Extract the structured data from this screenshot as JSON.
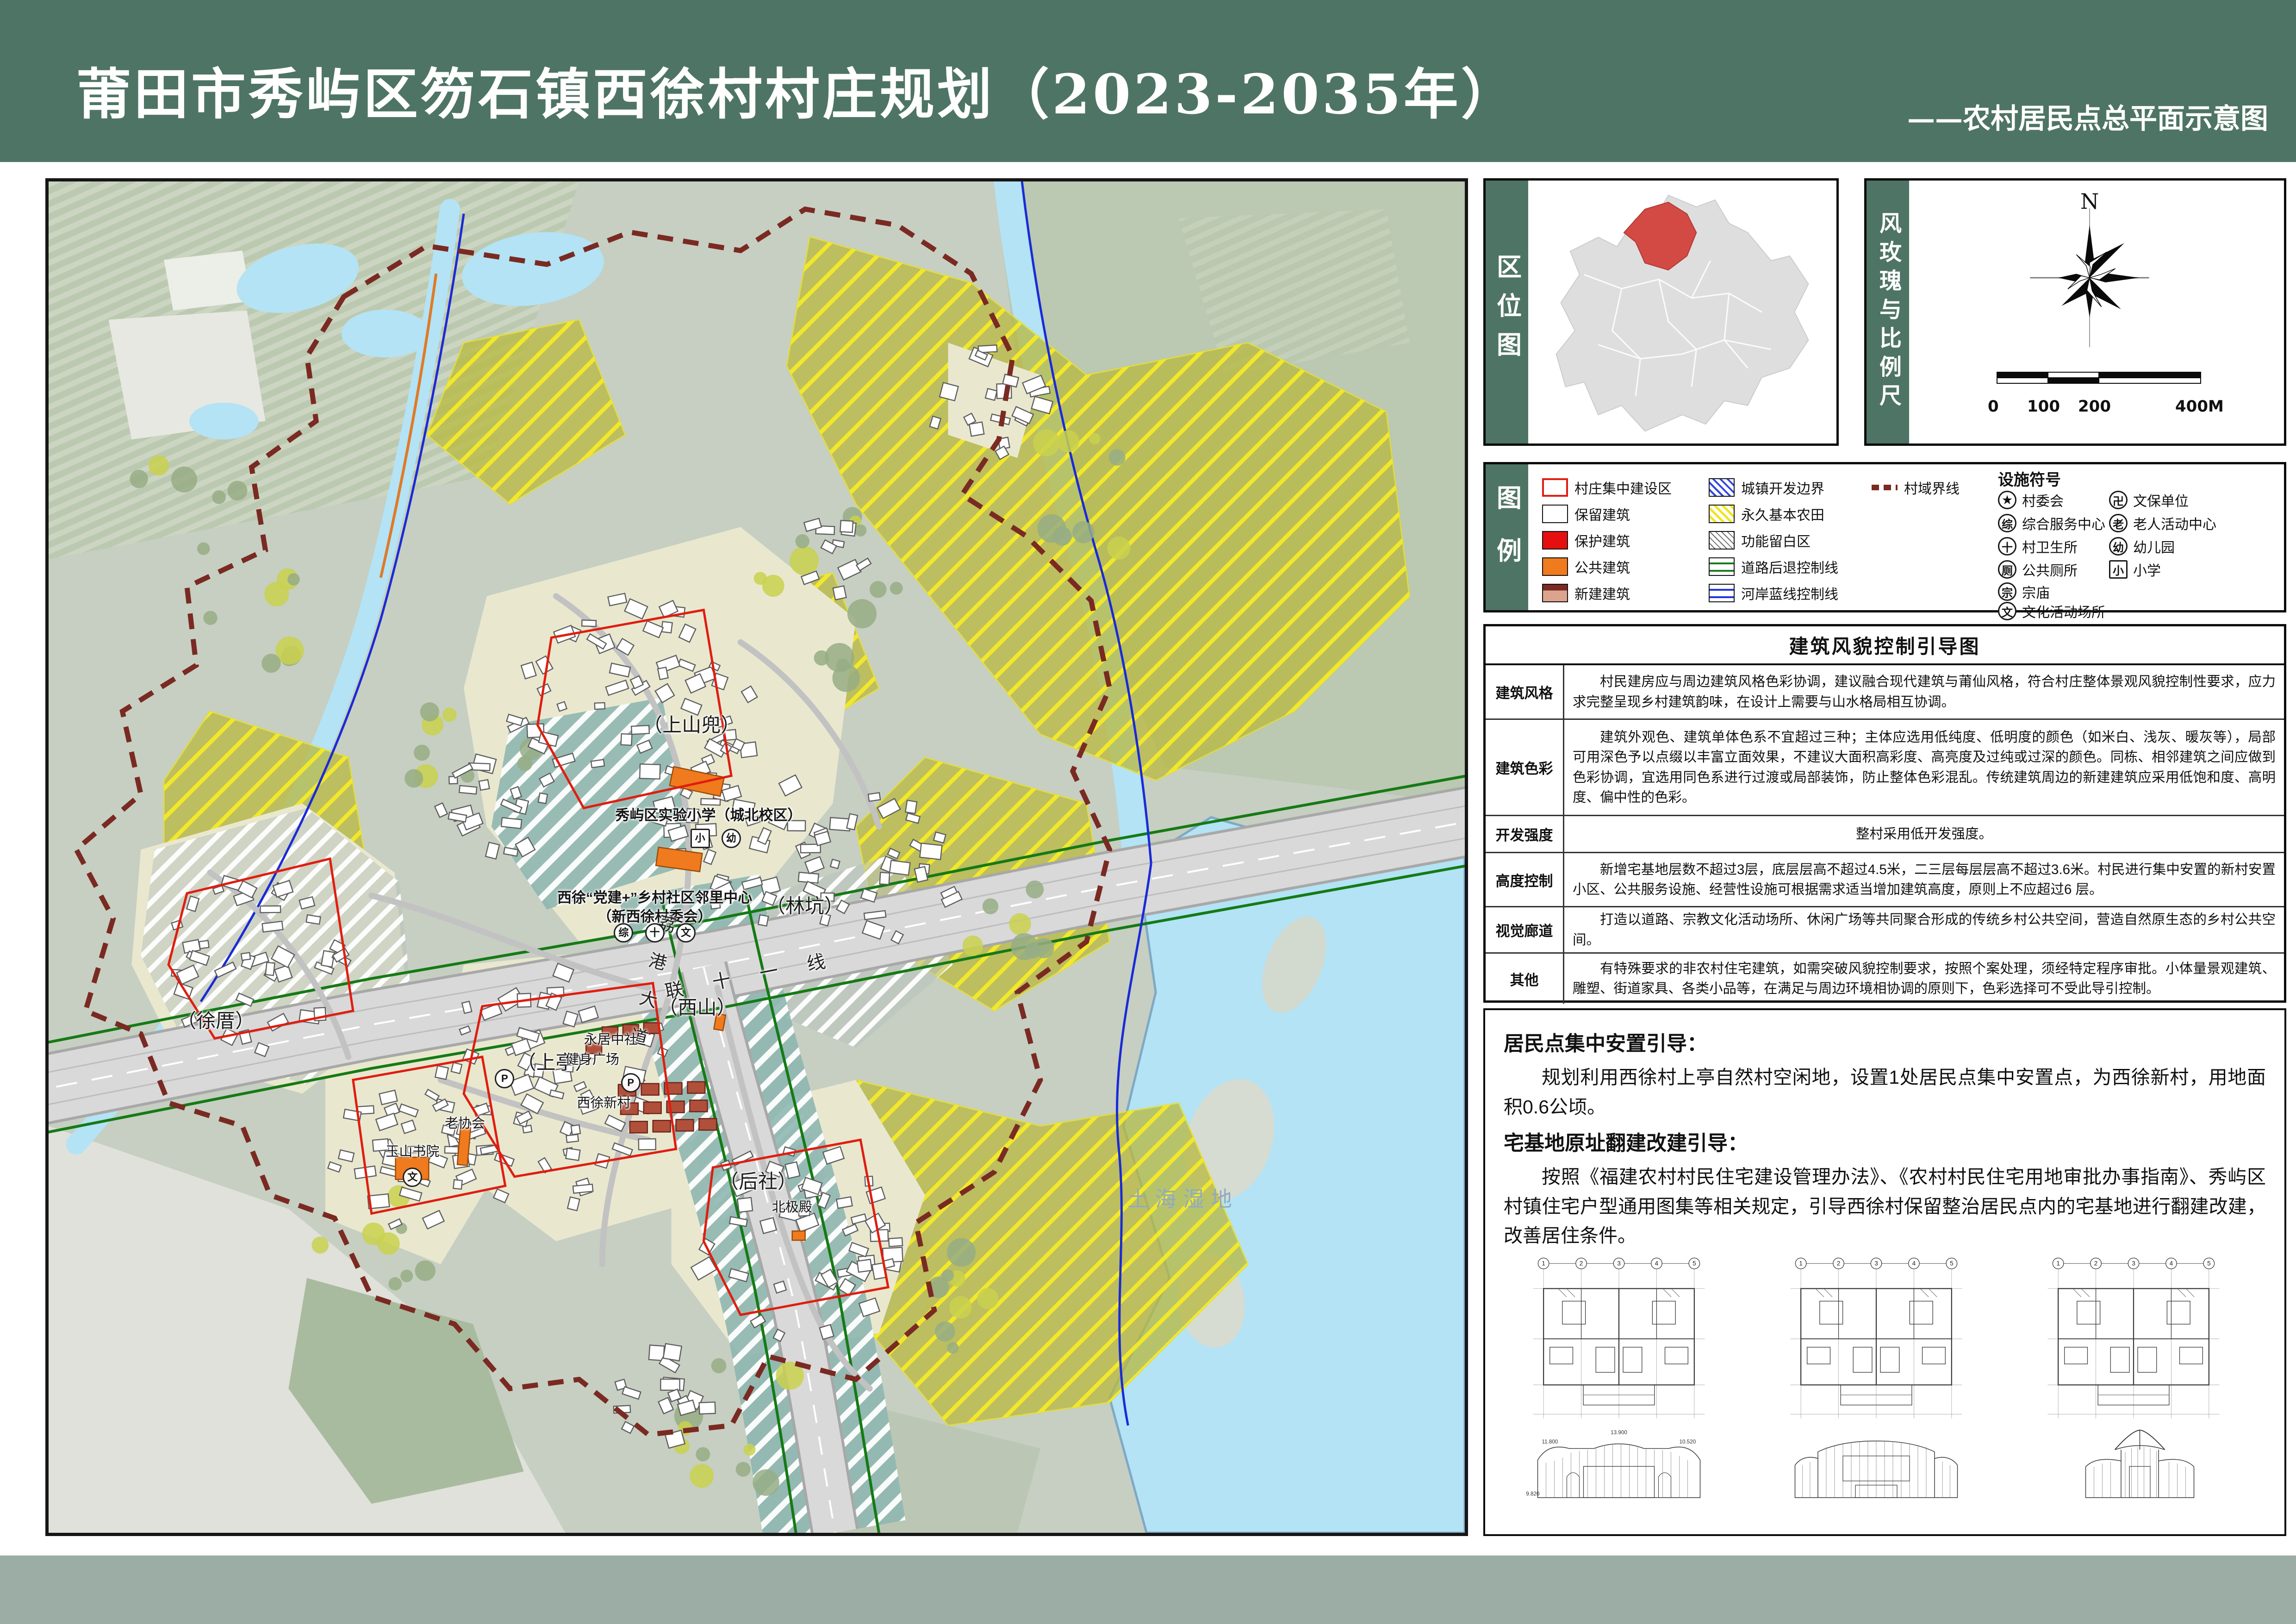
{
  "header": {
    "title": "莆田市秀屿区笏石镇西徐村村庄规划（2023-2035年）",
    "subtitle": "——农村居民点总平面示意图"
  },
  "panels": {
    "location_label": "区位图",
    "windrose_label": "风玫瑰与比例尺",
    "legend_label": "图例",
    "north": "N",
    "scale_ticks": [
      "0",
      "100",
      "200",
      "400M"
    ]
  },
  "legend": {
    "items": [
      {
        "label": "村庄集中建设区",
        "swatch": "red-outline"
      },
      {
        "label": "保留建筑",
        "swatch": "white-outline"
      },
      {
        "label": "保护建筑",
        "swatch": "red-fill"
      },
      {
        "label": "公共建筑",
        "swatch": "orange-fill"
      },
      {
        "label": "新建建筑",
        "swatch": "new-building"
      },
      {
        "label": "城镇开发边界",
        "swatch": "blue-hatch"
      },
      {
        "label": "永久基本农田",
        "swatch": "yellow-hatch"
      },
      {
        "label": "功能留白区",
        "swatch": "gray-hatch"
      },
      {
        "label": "道路后退控制线",
        "swatch": "green-lines"
      },
      {
        "label": "河岸蓝线控制线",
        "swatch": "blue-lines"
      },
      {
        "label": "村域界线",
        "swatch": "darkred-dash"
      }
    ],
    "facilities_title": "设施符号",
    "facilities": [
      {
        "glyph": "★",
        "label": "村委会"
      },
      {
        "glyph": "卍",
        "label": "文保单位"
      },
      {
        "glyph": "综",
        "label": "综合服务中心"
      },
      {
        "glyph": "老",
        "label": "老人活动中心"
      },
      {
        "glyph": "十",
        "label": "村卫生所"
      },
      {
        "glyph": "幼",
        "label": "幼儿园"
      },
      {
        "glyph": "厕",
        "label": "公共厕所"
      },
      {
        "glyph": "小",
        "label": "小学"
      },
      {
        "glyph": "宗",
        "label": "宗庙"
      },
      {
        "glyph": "文",
        "label": "文化活动场所"
      }
    ]
  },
  "guide_table": {
    "title": "建筑风貌控制引导图",
    "rows": [
      {
        "head": "建筑风格",
        "body": "村民建房应与周边建筑风格色彩协调，建议融合现代建筑与莆仙风格，符合村庄整体景观风貌控制性要求，应力求完整呈现乡村建筑韵味，在设计上需要与山水格局相互协调。"
      },
      {
        "head": "建筑色彩",
        "body": "建筑外观色、建筑单体色系不宜超过三种；主体应选用低纯度、低明度的颜色（如米白、浅灰、暖灰等），局部可用深色予以点缀以丰富立面效果，不建议大面积高彩度、高亮度及过纯或过深的颜色。同栋、相邻建筑之间应做到色彩协调，宜选用同色系进行过渡或局部装饰，防止整体色彩混乱。传统建筑周边的新建建筑应采用低饱和度、高明度、偏中性的色彩。"
      },
      {
        "head": "开发强度",
        "body": "整村采用低开发强度。"
      },
      {
        "head": "高度控制",
        "body": "新增宅基地层数不超过3层，底层层高不超过4.5米，二三层每层层高不超过3.6米。村民进行集中安置的新村安置小区、公共服务设施、经营性设施可根据需求适当增加建筑高度，原则上不应超过6 层。"
      },
      {
        "head": "视觉廊道",
        "body": "打造以道路、宗教文化活动场所、休闲广场等共同聚合形成的传统乡村公共空间，营造自然原生态的乡村公共空间。"
      },
      {
        "head": "其他",
        "body": "有特殊要求的非农村住宅建筑，如需突破风貌控制要求，按照个案处理，须经特定程序审批。小体量景观建筑、雕塑、街道家具、各类小品等，在满足与周边环境相协调的原则下，色彩选择可不受此导引控制。"
      }
    ]
  },
  "guidance": {
    "s1_title": "居民点集中安置引导：",
    "s1_body": "规划利用西徐村上亭自然村空闲地，设置1处居民点集中安置点，为西徐新村，用地面积0.6公顷。",
    "s2_title": "宅基地原址翻建改建引导：",
    "s2_body": "按照《福建农村村民住宅建设管理办法》、《农村村民住宅用地审批办事指南》、秀屿区村镇住宅户型通用图集等相关规定，引导西徐村保留整治居民点内的宅基地进行翻建改建，改善居住条件。"
  },
  "drawings": {
    "axes": [
      "1",
      "2",
      "3",
      "4",
      "5"
    ],
    "levels": [
      "13.900",
      "11.800",
      "10.520",
      "9.820"
    ]
  },
  "map": {
    "labels": [
      {
        "text": "（上山兜）",
        "kind": "village"
      },
      {
        "text": "秀屿区实验小学（城北校区）",
        "kind": "poi"
      },
      {
        "text": "西徐“党建+”乡村社区邻里中心",
        "kind": "poi"
      },
      {
        "text": "（新西徐村委会）",
        "kind": "poi"
      },
      {
        "text": "联十一线",
        "kind": "road"
      },
      {
        "text": "荔港大道",
        "kind": "road"
      },
      {
        "text": "（西山）",
        "kind": "village"
      },
      {
        "text": "（林坑）",
        "kind": "village"
      },
      {
        "text": "（上亭）",
        "kind": "village"
      },
      {
        "text": "健身广场",
        "kind": "poi"
      },
      {
        "text": "永居中社",
        "kind": "poi"
      },
      {
        "text": "西徐新村",
        "kind": "poi"
      },
      {
        "text": "（后社）",
        "kind": "village"
      },
      {
        "text": "北极殿",
        "kind": "poi"
      },
      {
        "text": "（徐厝）",
        "kind": "village"
      },
      {
        "text": "玉山书院",
        "kind": "poi"
      },
      {
        "text": "老协会",
        "kind": "poi"
      },
      {
        "text": "土海湿地",
        "kind": "water"
      }
    ],
    "icons": [
      {
        "glyph": "小",
        "shape": "square"
      },
      {
        "glyph": "幼",
        "shape": "circle"
      },
      {
        "glyph": "综",
        "shape": "circle"
      },
      {
        "glyph": "十",
        "shape": "circle"
      },
      {
        "glyph": "文",
        "shape": "circle"
      },
      {
        "glyph": "文",
        "shape": "circle"
      },
      {
        "glyph": "P",
        "shape": "circle"
      },
      {
        "glyph": "P",
        "shape": "circle"
      }
    ],
    "colors": {
      "header_green": "#4e7465",
      "boundary_red": "#7a2a22",
      "farmland_yellow": "#f4ea28",
      "construction_red": "#e01d10",
      "public_orange": "#f07a1e",
      "water_blue": "#b3e3f5",
      "highlight_region_red": "#d24a43"
    }
  }
}
